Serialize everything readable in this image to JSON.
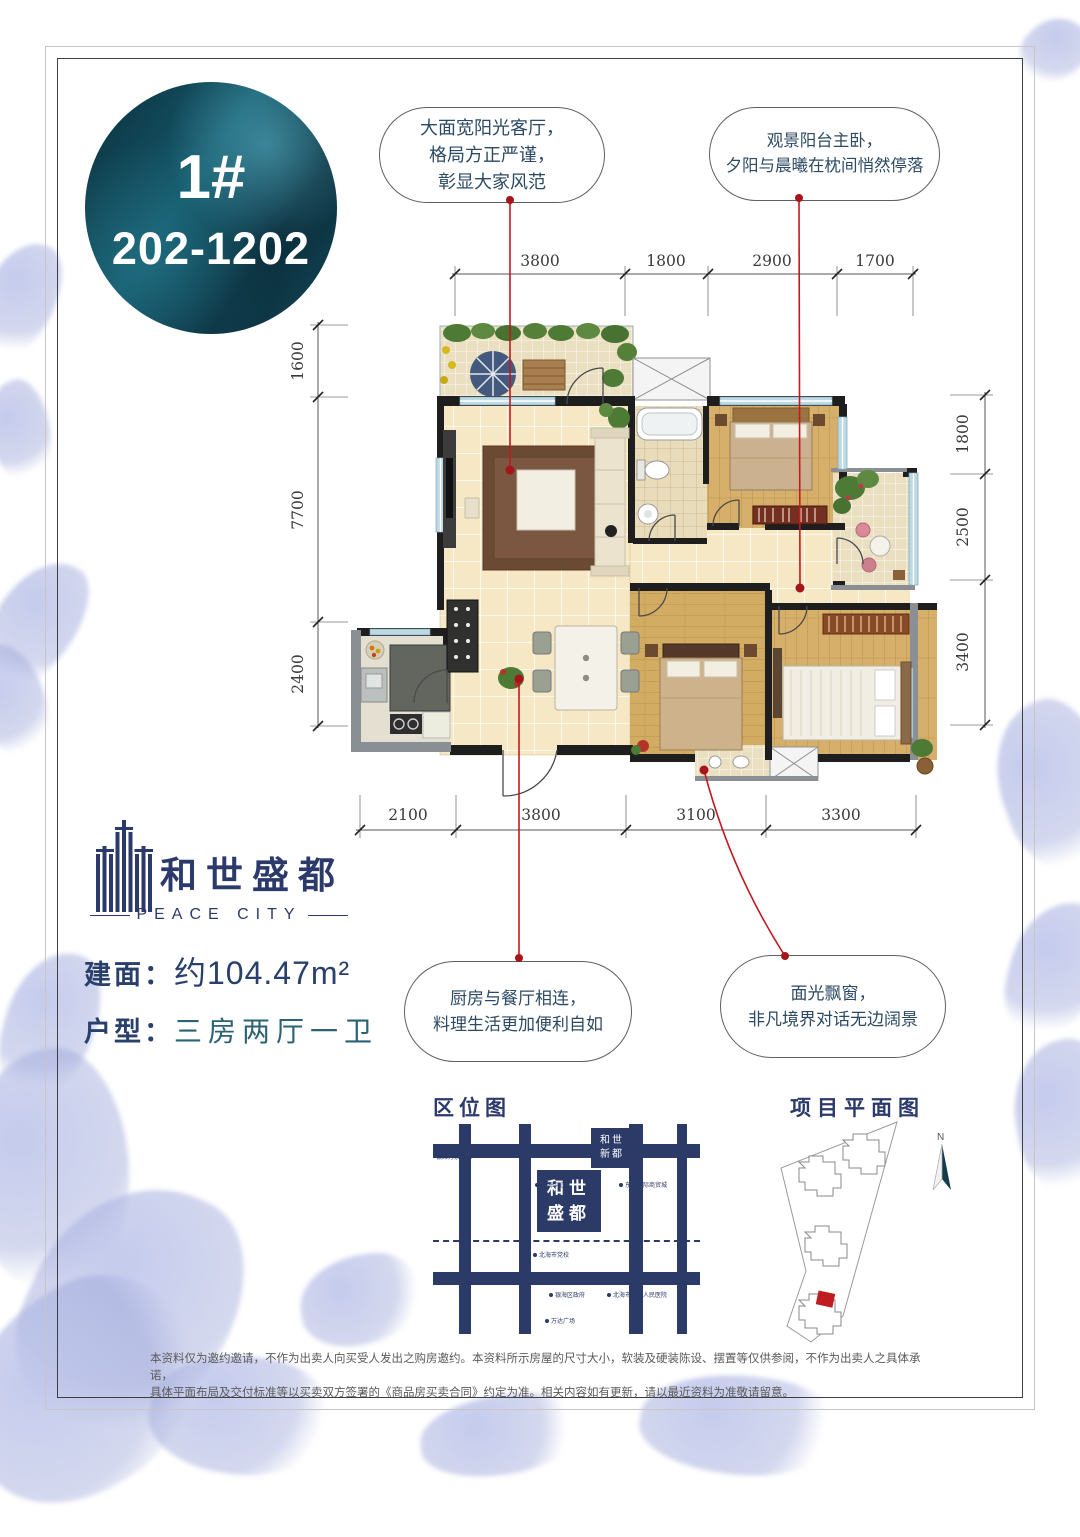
{
  "badge": {
    "building": "1#",
    "units": "202-1202"
  },
  "callouts": {
    "living": {
      "line1": "大面宽阳光客厅，",
      "line2": "格局方正严谨，",
      "line3": "彰显大家风范"
    },
    "master": {
      "line1": "观景阳台主卧，",
      "line2": "夕阳与晨曦在枕间悄然停落"
    },
    "kitchen": {
      "line1": "厨房与餐厅相连，",
      "line2": "料理生活更加便利自如"
    },
    "bay": {
      "line1": "面光飘窗，",
      "line2": "非凡境界对话无边阔景"
    }
  },
  "dimensions": {
    "top": [
      "3800",
      "1800",
      "2900",
      "1700"
    ],
    "bottom": [
      "2100",
      "3800",
      "3100",
      "3300"
    ],
    "left": [
      "1600",
      "7700",
      "2400"
    ],
    "right": [
      "1800",
      "2500",
      "3400"
    ]
  },
  "logo": {
    "name": "和世盛都",
    "english": "PEACE CITY"
  },
  "specs": {
    "area_label": "建面：",
    "area_value": "约104.47m²",
    "type_label": "户型：",
    "type_value": "三房两厅一卫"
  },
  "location_map": {
    "title": "区位图",
    "brand_main": {
      "line1": "和世",
      "line2": "盛都"
    },
    "brand_sister": {
      "line1": "和世",
      "line2": "新都"
    },
    "pois": [
      {
        "label": "银滩万泉城"
      },
      {
        "label": "中国工商银行"
      },
      {
        "label": "北海中心"
      },
      {
        "label": "北海市第九中学"
      },
      {
        "label": "北海市党校"
      },
      {
        "label": "东盟国际商贸城"
      },
      {
        "label": "银海区政府"
      },
      {
        "label": "北海市第二人民医院"
      },
      {
        "label": "万达广场"
      }
    ]
  },
  "site_plan": {
    "title": "项目平面图",
    "north_label": "N"
  },
  "disclaimer": {
    "line1": "本资料仅为邀约邀请，不作为出卖人向买受人发出之购房邀约。本资料所示房屋的尺寸大小，软装及硬装陈设、摆置等仅供参阅，不作为出卖人之具体承诺，",
    "line2": "具体平面布局及交付标准等以买卖双方签署的《商品房买卖合同》约定为准。相关内容如有更新，请以最近资料为准敬请留意。"
  }
}
